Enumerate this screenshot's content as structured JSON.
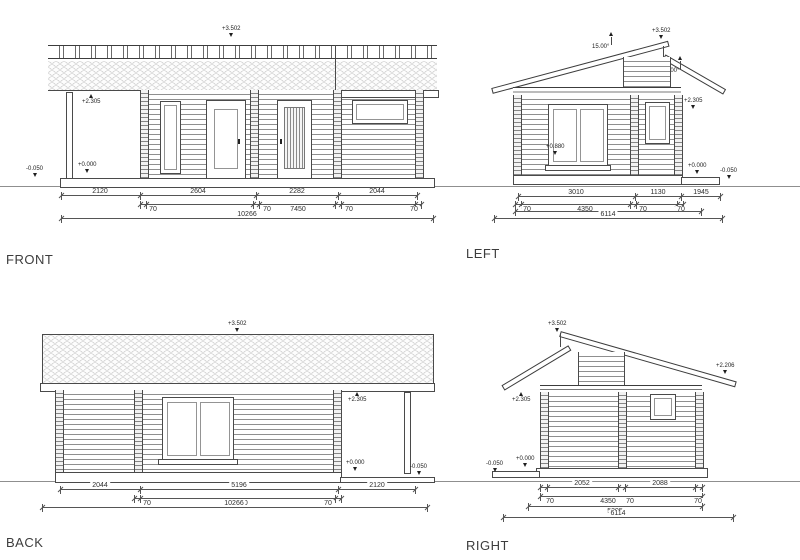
{
  "views": {
    "front": {
      "label": "FRONT",
      "dims": {
        "s1": "2120",
        "s2": "2604",
        "s3": "2282",
        "s4": "2044",
        "g1": "70",
        "g2": "70",
        "mid": "7450",
        "g3": "70",
        "g4": "70",
        "total": "10266"
      },
      "markers": {
        "ridge": "+3.502",
        "eave": "+2.305",
        "floor": "+0.000",
        "ground": "-0.050"
      }
    },
    "left": {
      "label": "LEFT",
      "angles": {
        "a1": "15.00°",
        "a2": "15.00°"
      },
      "dims": {
        "s1": "3010",
        "s2": "1130",
        "s3": "1945",
        "g1": "70",
        "mid": "4350",
        "g2": "70",
        "g3": "70",
        "sub": "5395",
        "total": "6114"
      },
      "markers": {
        "ridge": "+3.502",
        "eave": "+2.305",
        "sill": "+0.880",
        "floor": "+0.000",
        "ground": "-0.050"
      }
    },
    "back": {
      "label": "BACK",
      "dims": {
        "s1": "2044",
        "s2": "5196",
        "s3": "2120",
        "g1": "70",
        "mid": "7450",
        "g2": "70",
        "total": "10266"
      },
      "markers": {
        "ridge": "+3.502",
        "eave": "+2.305",
        "floor": "+0.000",
        "ground": "-0.050"
      }
    },
    "right": {
      "label": "RIGHT",
      "dims": {
        "s1": "2052",
        "s2": "2088",
        "g1": "70",
        "mid": "4350",
        "g2": "70",
        "g3": "70",
        "sub": "5395",
        "total": "6114"
      },
      "markers": {
        "ridge": "+3.502",
        "porch_eave": "+2.305",
        "eave": "+2.206",
        "floor": "+0.000",
        "ground": "-0.050"
      }
    }
  }
}
